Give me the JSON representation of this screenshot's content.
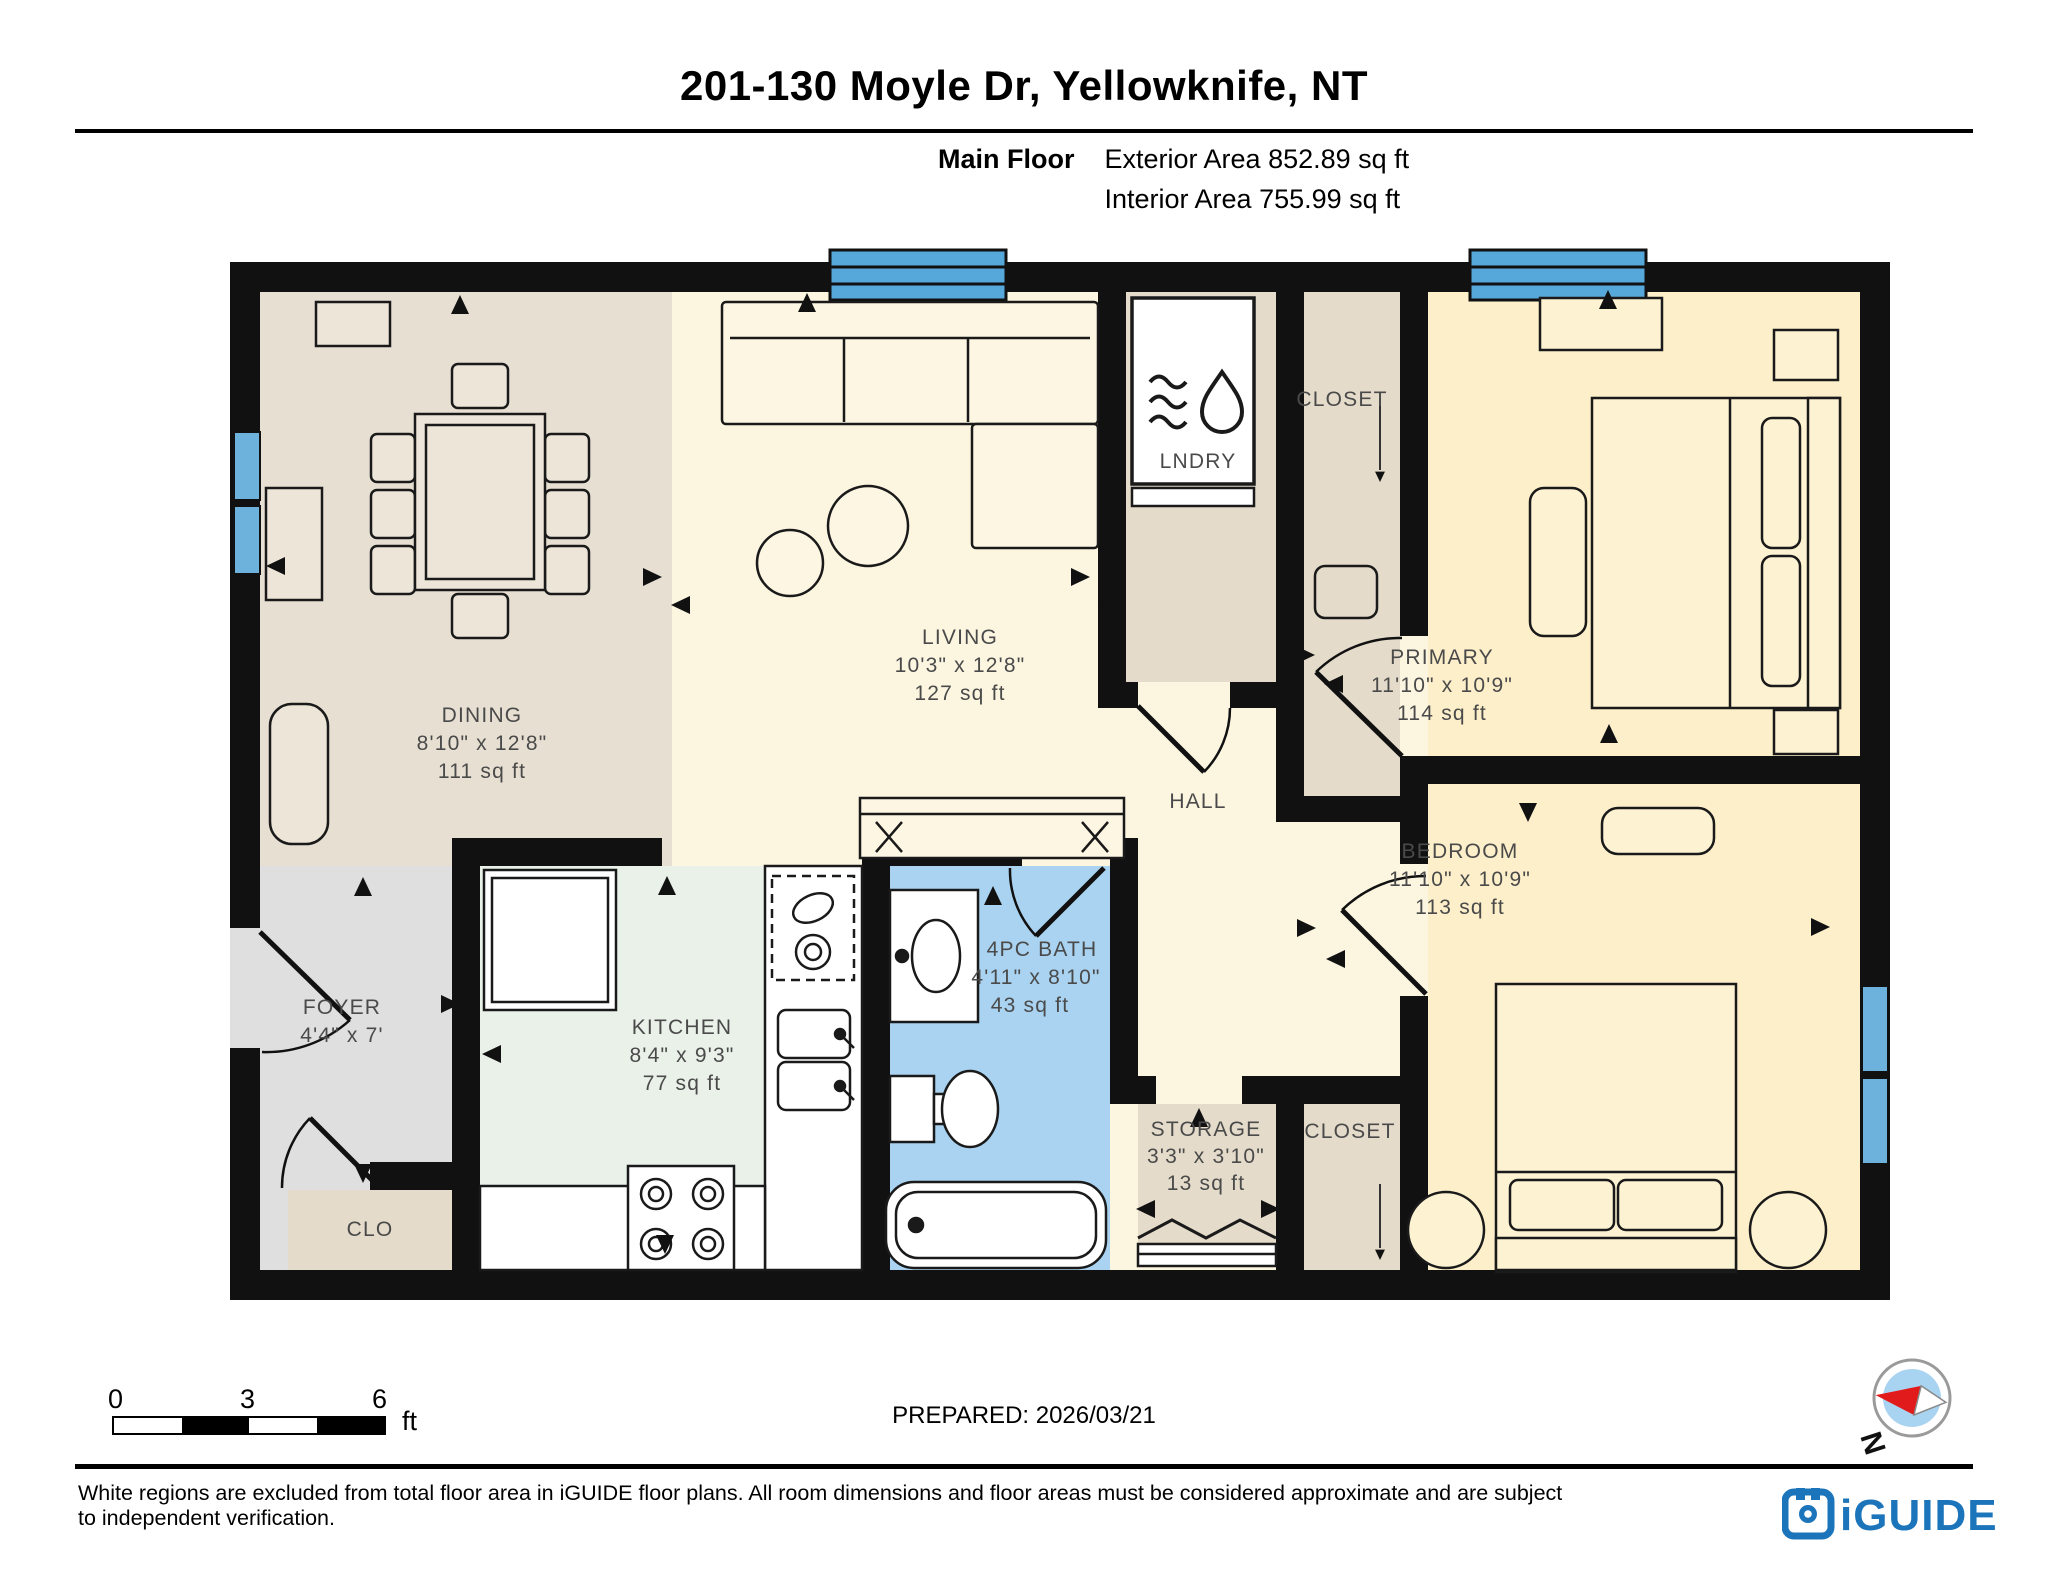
{
  "header": {
    "title": "201-130 Moyle Dr, Yellowknife, NT",
    "floor_label": "Main Floor",
    "exterior_area": "Exterior Area 852.89 sq ft",
    "interior_area": "Interior Area 755.99 sq ft"
  },
  "rooms": {
    "dining": {
      "name": "DINING",
      "dims": "8'10\" x 12'8\"",
      "area": "111 sq ft"
    },
    "living": {
      "name": "LIVING",
      "dims": "10'3\" x 12'8\"",
      "area": "127 sq ft"
    },
    "lndry": {
      "name": "LNDRY"
    },
    "closet_top": {
      "name": "CLOSET"
    },
    "primary": {
      "name": "PRIMARY",
      "dims": "11'10\" x 10'9\"",
      "area": "114 sq ft"
    },
    "hall": {
      "name": "HALL"
    },
    "bedroom": {
      "name": "BEDROOM",
      "dims": "11'10\" x 10'9\"",
      "area": "113 sq ft"
    },
    "foyer": {
      "name": "FOYER",
      "dims": "4'4\" x 7'"
    },
    "kitchen": {
      "name": "KITCHEN",
      "dims": "8'4\" x 9'3\"",
      "area": "77 sq ft"
    },
    "bath": {
      "name": "4PC BATH",
      "dims": "4'11\" x 8'10\"",
      "area": "43 sq ft"
    },
    "storage": {
      "name": "STORAGE",
      "dims": "3'3\" x 3'10\"",
      "area": "13 sq ft"
    },
    "closet_bottom": {
      "name": "CLOSET"
    },
    "clo": {
      "name": "CLO"
    }
  },
  "scale_bar": {
    "tick0": "0",
    "tick1": "3",
    "tick2": "6",
    "unit": "ft"
  },
  "footer": {
    "prepared": "PREPARED: 2026/03/21",
    "disclaimer": "White regions are excluded from total floor area in iGUIDE floor plans. All room dimensions and floor areas must be considered approximate and are subject to independent verification.",
    "brand": "iGUIDE",
    "compass_label": "N"
  },
  "colors": {
    "wall": "#111111",
    "living_floor": "#fcf5e0",
    "bedroom_floor": "#fcefca",
    "dining_floor": "#e7e0d2",
    "closet_floor": "#e4dbca",
    "foyer_floor": "#dfdfdf",
    "kitchen_floor": "#e9f1e9",
    "bath_floor": "#a9d3f0",
    "window_blue": "#57a8da",
    "brand_blue": "#1c75ba",
    "compass_red": "#e11b1b"
  }
}
